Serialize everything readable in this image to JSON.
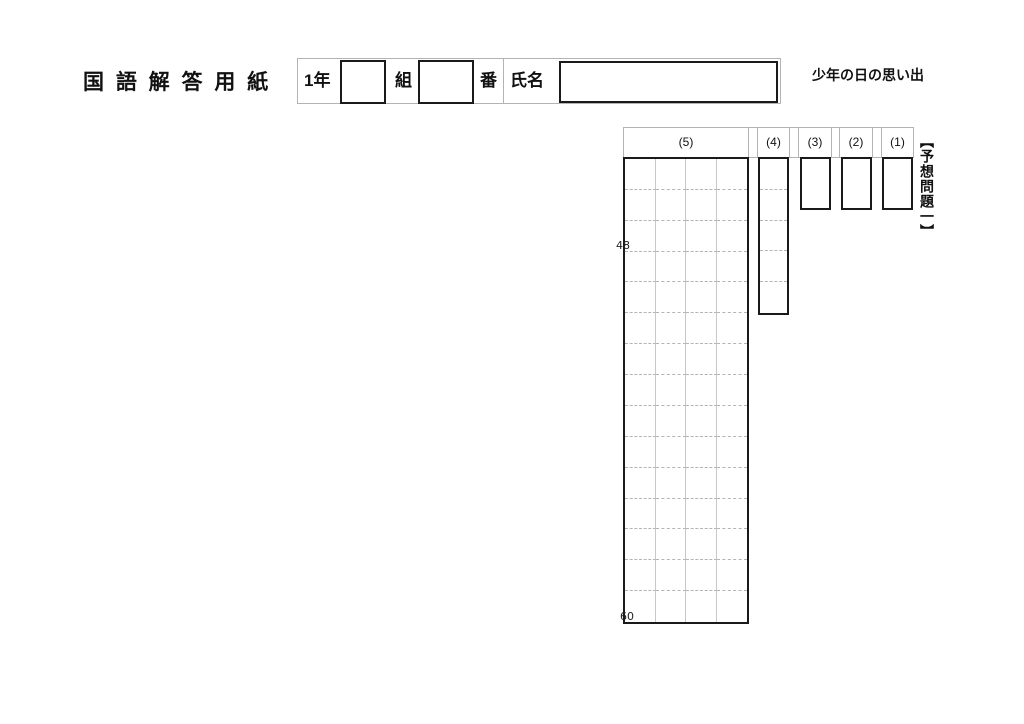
{
  "page": {
    "title": "国 語 解 答 用 紙",
    "subject_title": "少年の日の思い出",
    "problem_set_label": "【予想問題一】"
  },
  "student_info": {
    "grade_label": "1年",
    "class_label": "組",
    "number_label": "番",
    "name_label": "氏名",
    "class_value": "",
    "number_value": "",
    "name_value": ""
  },
  "answers": {
    "columns": [
      {
        "id": "5",
        "label": "(5)"
      },
      {
        "id": "4",
        "label": "(4)"
      },
      {
        "id": "3",
        "label": "(3)"
      },
      {
        "id": "2",
        "label": "(2)"
      },
      {
        "id": "1",
        "label": "(1)"
      }
    ],
    "writing_grid": {
      "columns": 4,
      "rows": 15,
      "total_cells": 60,
      "marker_48": "48",
      "marker_60": "60"
    },
    "q4_rows": 5
  },
  "colors": {
    "box_border": "#1a1a1a",
    "table_border": "#b3b3b3",
    "grid_line": "#c8c8c8",
    "dashed_line": "#b4b4b4"
  }
}
